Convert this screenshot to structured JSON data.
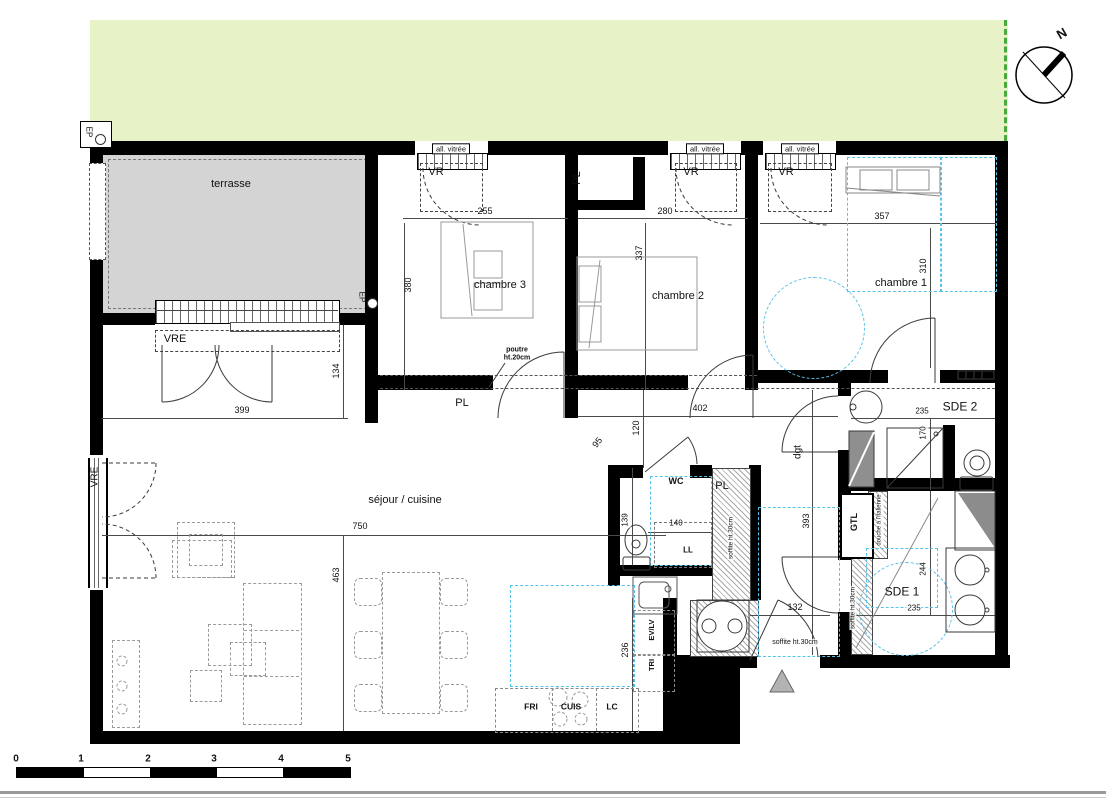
{
  "colors": {
    "lawn": "#e7f3c6",
    "site_boundary_green": "#48a93c",
    "terrace_gray": "#d4d4d4",
    "wall_black": "#000000",
    "accessibility_blue": "#56c2ea",
    "furniture_dash_gray": "#9b9b9b",
    "entrance_marker_gray": "#b3b3b3"
  },
  "scale_bar": {
    "ticks": [
      "0",
      "1",
      "2",
      "3",
      "4",
      "5"
    ]
  },
  "compass": {
    "north_label": "N"
  },
  "labels": [
    {
      "name": "room-label-terrasse",
      "text": "terrasse",
      "x": 231,
      "y": 184,
      "size": 11
    },
    {
      "name": "room-label-chambre3",
      "text": "chambre 3",
      "x": 500,
      "y": 285,
      "size": 11
    },
    {
      "name": "room-label-chambre2",
      "text": "chambre 2",
      "x": 678,
      "y": 296,
      "size": 11
    },
    {
      "name": "room-label-chambre1",
      "text": "chambre 1",
      "x": 901,
      "y": 283,
      "size": 11
    },
    {
      "name": "room-label-sejour-cuisine",
      "text": "séjour / cuisine",
      "x": 405,
      "y": 500,
      "size": 11
    },
    {
      "name": "room-label-sde2",
      "text": "SDE 2",
      "x": 960,
      "y": 407,
      "size": 12
    },
    {
      "name": "room-label-sde1",
      "text": "SDE 1",
      "x": 902,
      "y": 592,
      "size": 12
    },
    {
      "name": "room-label-wc",
      "text": "WC",
      "x": 676,
      "y": 482,
      "size": 9,
      "bold": 1
    },
    {
      "name": "room-label-dgt",
      "text": "dgt",
      "x": 798,
      "y": 452,
      "size": 10,
      "rot": -90
    },
    {
      "name": "fixture-label-ll",
      "text": "LL",
      "x": 688,
      "y": 551,
      "size": 8,
      "bold": 1
    },
    {
      "name": "closet-label-pl-top",
      "text": "PL",
      "x": 577,
      "y": 178,
      "size": 11,
      "rot": -90
    },
    {
      "name": "closet-label-pl-corridor",
      "text": "PL",
      "x": 462,
      "y": 403,
      "size": 11
    },
    {
      "name": "closet-label-pl-shaft",
      "text": "PL",
      "x": 722,
      "y": 486,
      "size": 11
    },
    {
      "name": "closet-label-gtl",
      "text": "GTL",
      "x": 855,
      "y": 522,
      "size": 9,
      "rot": -90,
      "bold": 1
    },
    {
      "name": "fixture-label-tri",
      "text": "TRI",
      "x": 652,
      "y": 665,
      "size": 7.5,
      "rot": -90,
      "bold": 1
    },
    {
      "name": "fixture-label-ev-lv",
      "text": "EV/LV",
      "x": 652,
      "y": 630,
      "size": 7.5,
      "rot": -90,
      "bold": 1
    },
    {
      "name": "fixture-label-fri",
      "text": "FRI",
      "x": 531,
      "y": 707,
      "size": 8.5,
      "bold": 1
    },
    {
      "name": "fixture-label-cuis",
      "text": "CUIS",
      "x": 571,
      "y": 707,
      "size": 8.5,
      "bold": 1
    },
    {
      "name": "fixture-label-lc",
      "text": "LC",
      "x": 612,
      "y": 707,
      "size": 8.5,
      "bold": 1
    },
    {
      "name": "window-label-vr-1",
      "text": "VR",
      "x": 436,
      "y": 172,
      "size": 11
    },
    {
      "name": "window-label-vr-2",
      "text": "VR",
      "x": 691,
      "y": 172,
      "size": 11
    },
    {
      "name": "window-label-vr-3",
      "text": "VR",
      "x": 786,
      "y": 172,
      "size": 11
    },
    {
      "name": "window-label-vre-terrasse",
      "text": "VRE",
      "x": 175,
      "y": 339,
      "size": 11
    },
    {
      "name": "window-label-vre-left",
      "text": "VRE",
      "x": 95,
      "y": 477,
      "size": 10,
      "rot": -90
    },
    {
      "name": "window-label-allege-1",
      "text": "all. vitrée",
      "x": 451,
      "y": 149,
      "size": 7.5,
      "boxed": 1
    },
    {
      "name": "window-label-allege-2",
      "text": "all. vitrée",
      "x": 705,
      "y": 149,
      "size": 7.5,
      "boxed": 1
    },
    {
      "name": "window-label-allege-3",
      "text": "all. vitrée",
      "x": 800,
      "y": 149,
      "size": 7.5,
      "boxed": 1
    },
    {
      "name": "drain-label-ep-1",
      "text": "EP",
      "x": 88,
      "y": 132,
      "size": 8,
      "rot": 90
    },
    {
      "name": "drain-label-ep-2",
      "text": "EP",
      "x": 361,
      "y": 297,
      "size": 8,
      "rot": 90
    },
    {
      "name": "compass-label-north",
      "text": "N",
      "x": 1062,
      "y": 34,
      "size": 13,
      "rot": -30,
      "bold": 1
    },
    {
      "name": "annotation-poutre",
      "text": "poutre\nht.20cm",
      "x": 517,
      "y": 354,
      "size": 7,
      "bold": 1
    },
    {
      "name": "annotation-soffite-entry",
      "text": "soffite ht.30cm",
      "x": 795,
      "y": 643,
      "size": 7,
      "bgw": 1
    },
    {
      "name": "annotation-soffite-shaft",
      "text": "soffite ht.30cm",
      "x": 731,
      "y": 538,
      "size": 6.5,
      "rot": -90,
      "bgw": 1
    },
    {
      "name": "annotation-soffite-sde1",
      "text": "soffite ht.30cm",
      "x": 853,
      "y": 608,
      "size": 6.5,
      "rot": -90,
      "bgw": 1
    },
    {
      "name": "annotation-douche-italienne",
      "text": "douche à l'italienne",
      "x": 880,
      "y": 520,
      "size": 6,
      "rot": -90,
      "bgw": 1
    },
    {
      "name": "dim-255",
      "text": "255",
      "x": 485,
      "y": 212,
      "size": 9
    },
    {
      "name": "dim-280",
      "text": "280",
      "x": 665,
      "y": 212,
      "size": 9
    },
    {
      "name": "dim-357",
      "text": "357",
      "x": 882,
      "y": 217,
      "size": 9
    },
    {
      "name": "dim-380",
      "text": "380",
      "x": 409,
      "y": 285,
      "size": 9,
      "rot": -90
    },
    {
      "name": "dim-337",
      "text": "337",
      "x": 640,
      "y": 253,
      "size": 9,
      "rot": -90
    },
    {
      "name": "dim-310",
      "text": "310",
      "x": 924,
      "y": 266,
      "size": 9,
      "rot": -90
    },
    {
      "name": "dim-399",
      "text": "399",
      "x": 242,
      "y": 411,
      "size": 9
    },
    {
      "name": "dim-134",
      "text": "134",
      "x": 337,
      "y": 371,
      "size": 9,
      "rot": -90
    },
    {
      "name": "dim-402",
      "text": "402",
      "x": 700,
      "y": 409,
      "size": 9
    },
    {
      "name": "dim-120",
      "text": "120",
      "x": 637,
      "y": 428,
      "size": 9,
      "rot": -90
    },
    {
      "name": "dim-95",
      "text": "95",
      "x": 598,
      "y": 443,
      "size": 9,
      "rot": -52
    },
    {
      "name": "dim-750",
      "text": "750",
      "x": 360,
      "y": 527,
      "size": 9
    },
    {
      "name": "dim-463",
      "text": "463",
      "x": 337,
      "y": 575,
      "size": 9,
      "rot": -90
    },
    {
      "name": "dim-139",
      "text": "139",
      "x": 626,
      "y": 520,
      "size": 8,
      "rot": -90,
      "bgw": 1
    },
    {
      "name": "dim-140",
      "text": "140",
      "x": 676,
      "y": 524,
      "size": 8
    },
    {
      "name": "dim-236",
      "text": "236",
      "x": 626,
      "y": 650,
      "size": 9,
      "rot": -90,
      "bgw": 1
    },
    {
      "name": "dim-393",
      "text": "393",
      "x": 807,
      "y": 521,
      "size": 9,
      "rot": -90,
      "bgw": 1
    },
    {
      "name": "dim-132",
      "text": "132",
      "x": 795,
      "y": 608,
      "size": 9
    },
    {
      "name": "dim-235-sde2",
      "text": "235",
      "x": 922,
      "y": 412,
      "size": 8,
      "bgw": 1
    },
    {
      "name": "dim-170",
      "text": "170",
      "x": 924,
      "y": 433,
      "size": 8,
      "rot": -90,
      "bgw": 1
    },
    {
      "name": "dim-244",
      "text": "244",
      "x": 924,
      "y": 569,
      "size": 8,
      "rot": -90,
      "bgw": 1
    },
    {
      "name": "dim-235-sde1",
      "text": "235",
      "x": 914,
      "y": 609,
      "size": 8,
      "bgw": 1
    },
    {
      "name": "scale-tick-0",
      "text": "0",
      "x": 16,
      "y": 759,
      "size": 10,
      "bold": 1
    },
    {
      "name": "scale-tick-1",
      "text": "1",
      "x": 81,
      "y": 759,
      "size": 10,
      "bold": 1
    },
    {
      "name": "scale-tick-2",
      "text": "2",
      "x": 148,
      "y": 759,
      "size": 10,
      "bold": 1
    },
    {
      "name": "scale-tick-3",
      "text": "3",
      "x": 214,
      "y": 759,
      "size": 10,
      "bold": 1
    },
    {
      "name": "scale-tick-4",
      "text": "4",
      "x": 281,
      "y": 759,
      "size": 10,
      "bold": 1
    },
    {
      "name": "scale-tick-5",
      "text": "5",
      "x": 348,
      "y": 759,
      "size": 10,
      "bold": 1
    }
  ]
}
